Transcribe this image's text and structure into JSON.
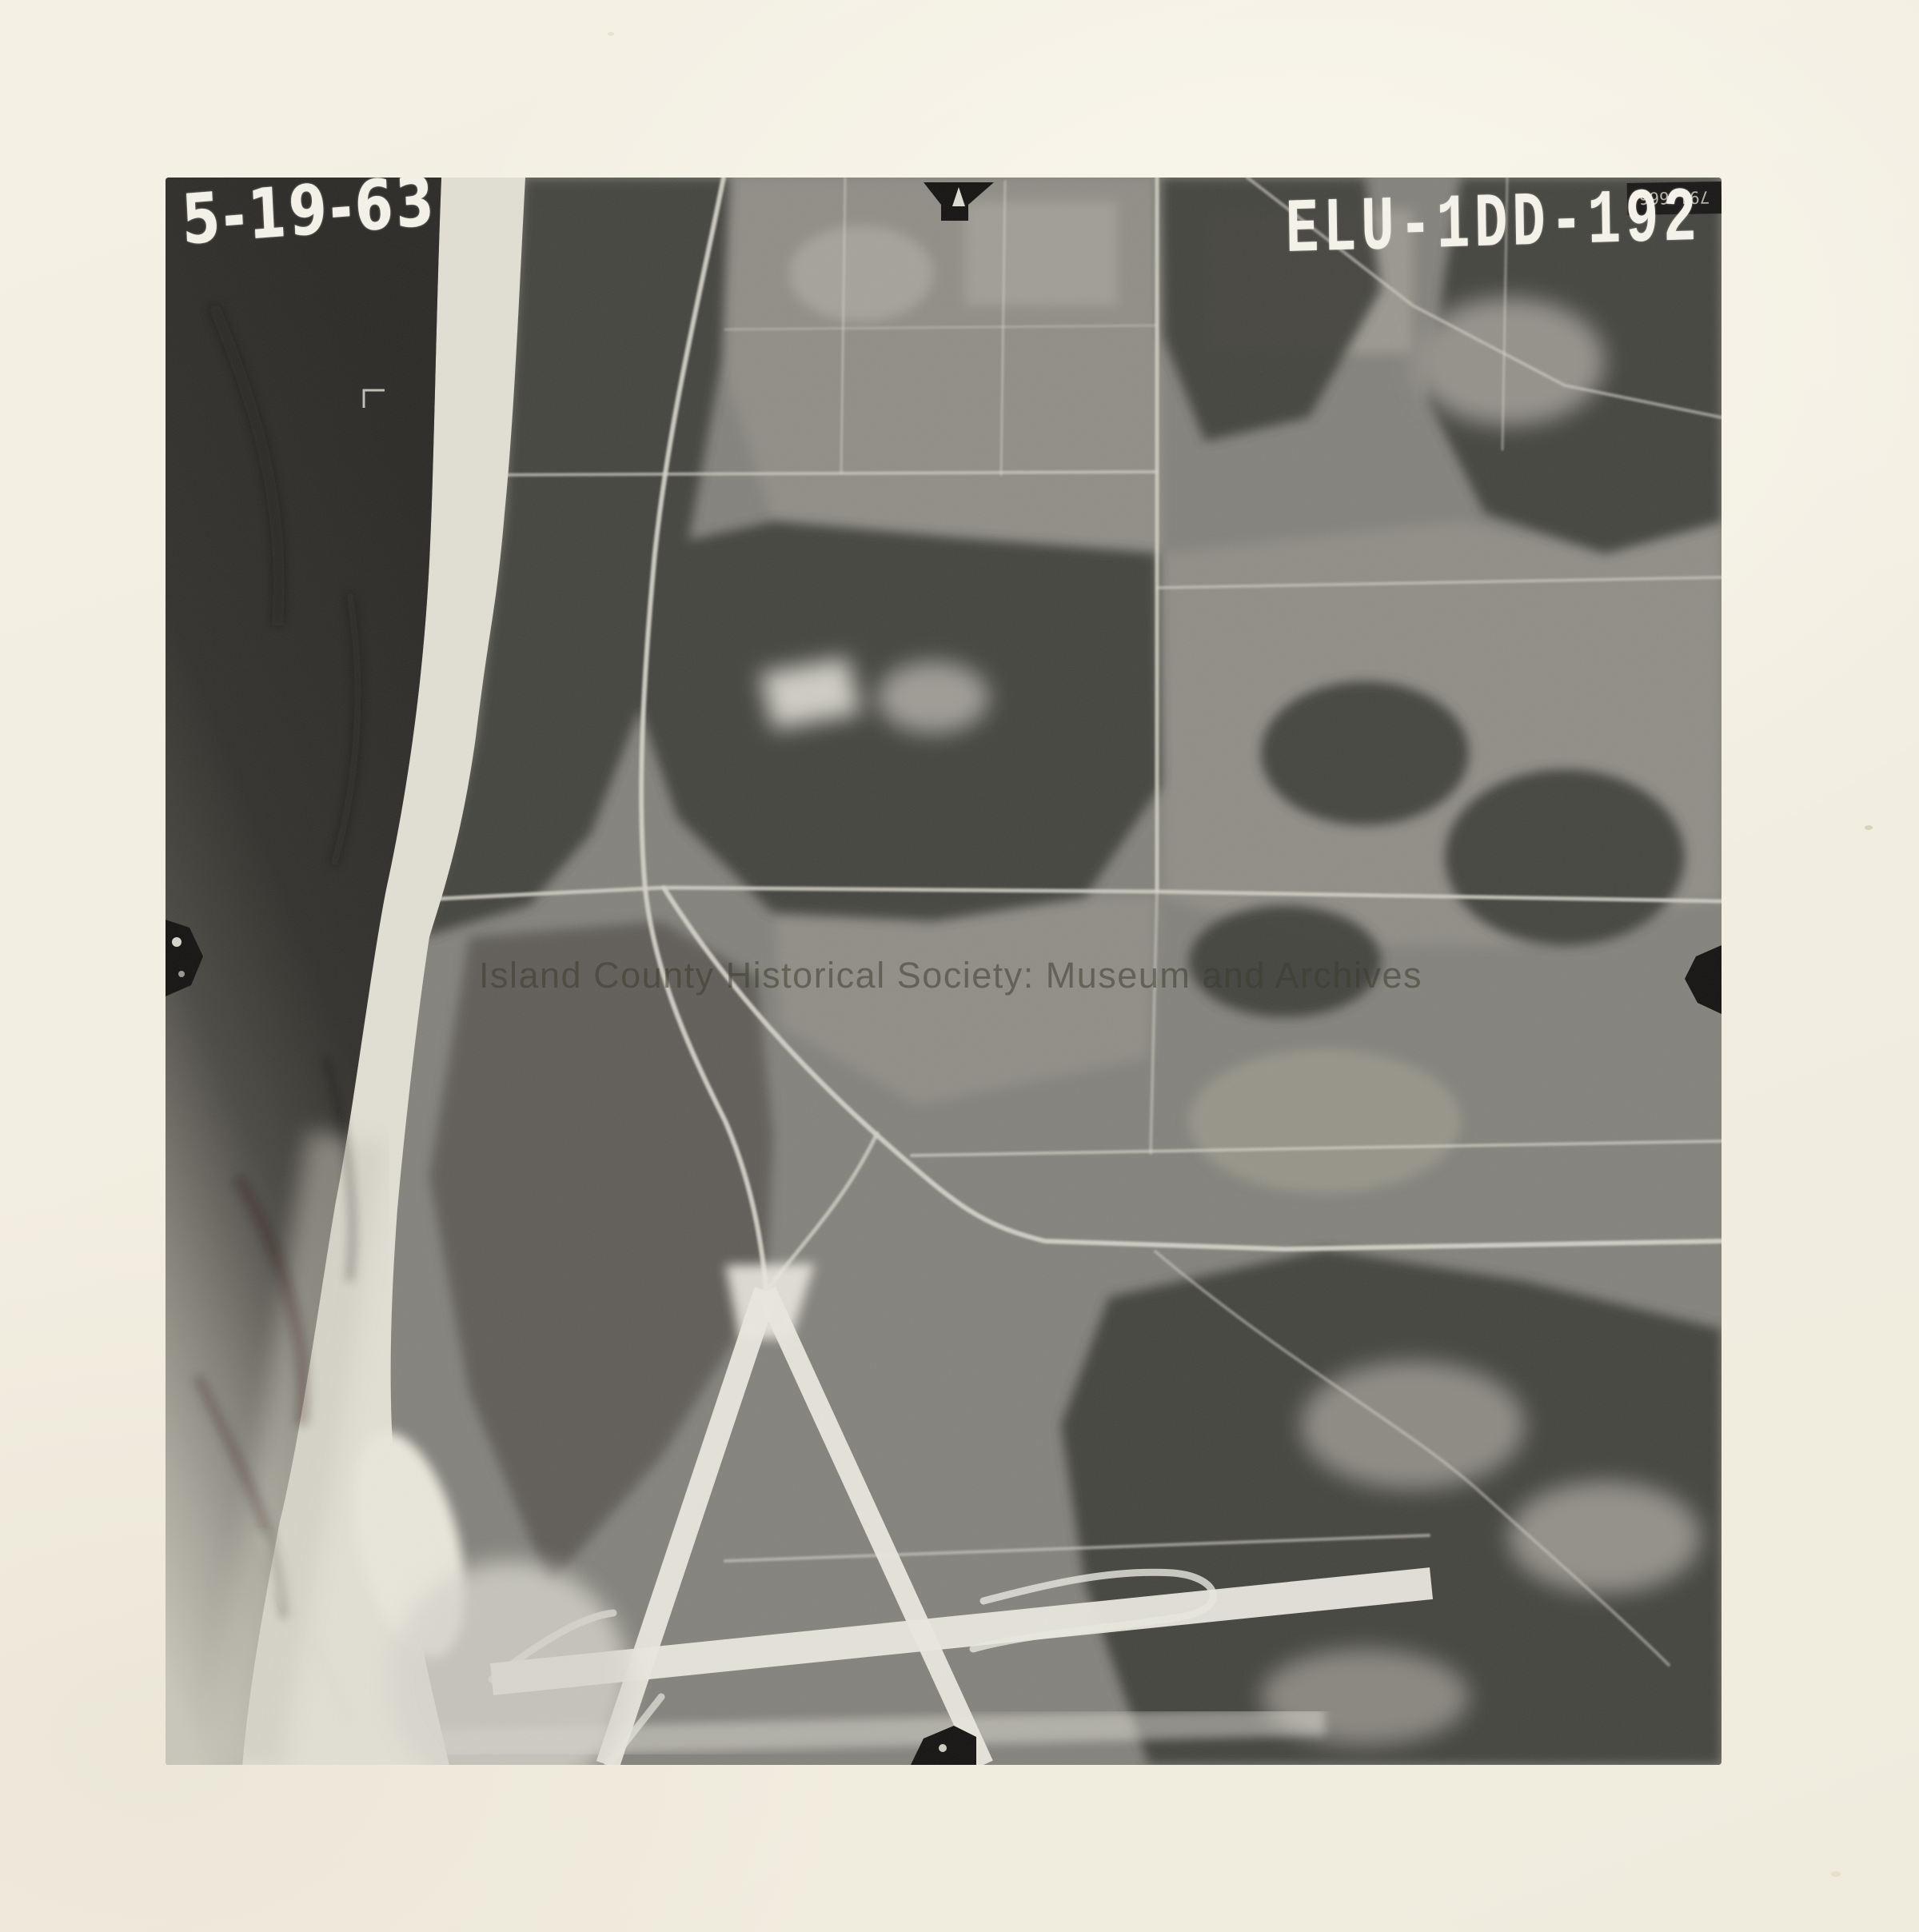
{
  "photo": {
    "date_annotation": "5-19-63",
    "photo_id": "ELU-1DD-192",
    "corner_stamp": "791,666",
    "watermark_text": "Island County Historical Society: Museum and Archives"
  },
  "colors": {
    "paper": "#f2eee2",
    "water_dark": "#2b2a27",
    "water_light": "#c9c7ba",
    "land": "#84837c",
    "forest": "#413f3a",
    "field": "#908e86",
    "beach": "#e2e0d4",
    "runway": "#eae8de",
    "road": "#d3d1c6",
    "fiducial": "#141311",
    "stamp_text": "#f3f1e8",
    "watermark_gray": "rgba(60,60,46,0.55)"
  }
}
